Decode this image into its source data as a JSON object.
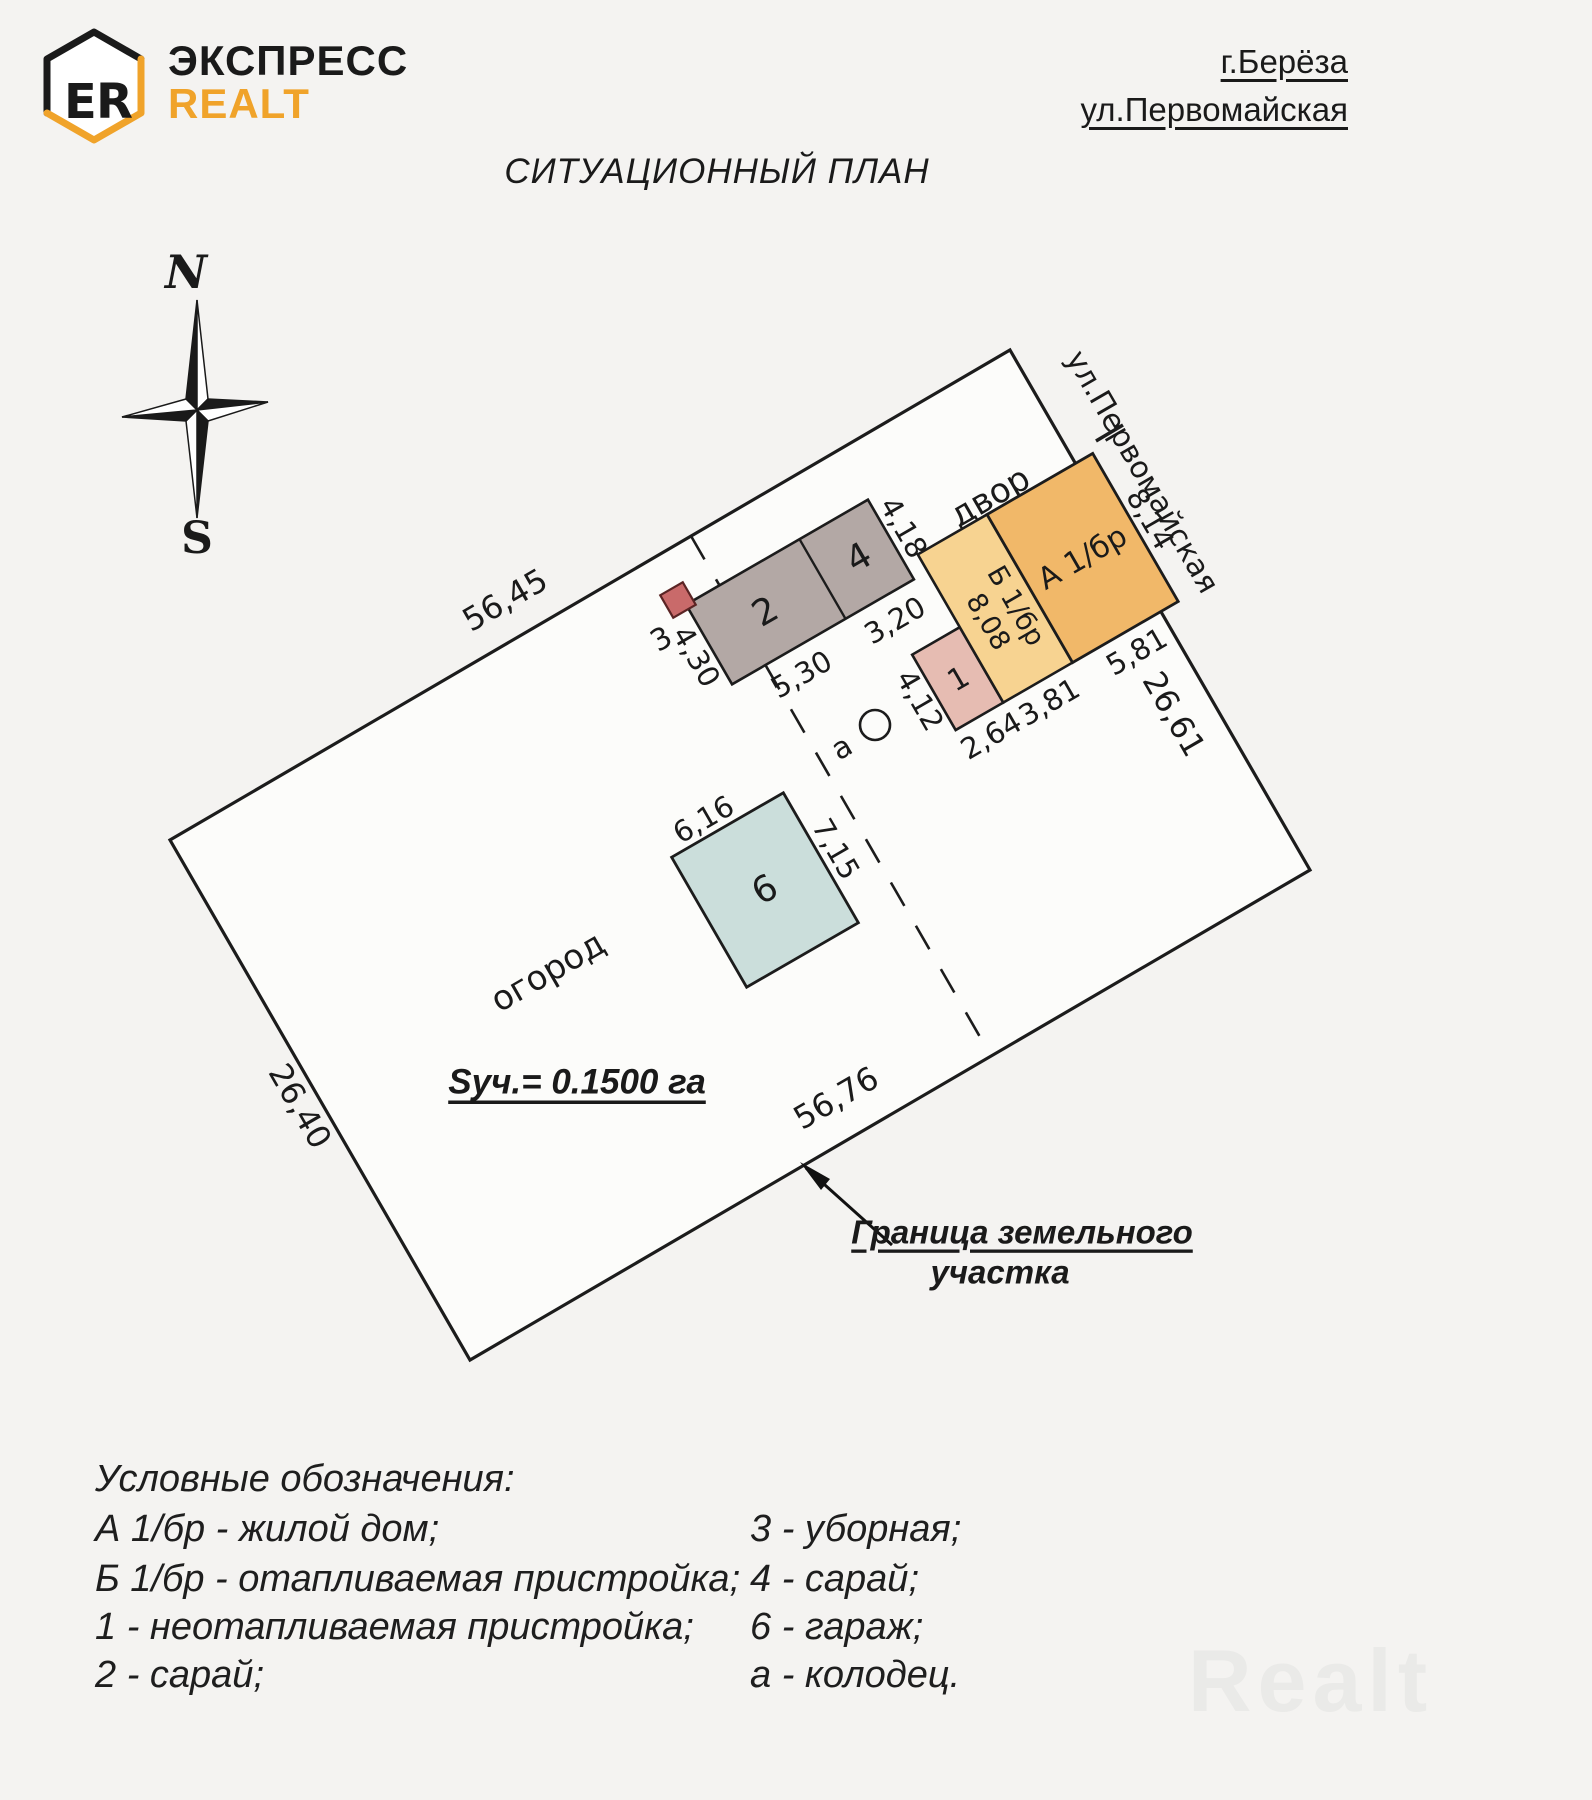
{
  "header": {
    "logo": {
      "letter_e": "E",
      "letter_r": "R"
    },
    "brand_line1": "ЭКСПРЕСС",
    "brand_line2": "REALT",
    "address": {
      "city": "г.Берёза",
      "street": "ул.Первомайская"
    }
  },
  "title": "СИТУАЦИОННЫЙ ПЛАН",
  "compass": {
    "north": "N",
    "south": "S"
  },
  "plan": {
    "dims": {
      "top": "56,45",
      "left": "26,40",
      "bottom": "56,76",
      "right": "26,61"
    },
    "zones": {
      "yard": "двор",
      "garden": "огород",
      "street": "ул.Первомайская"
    },
    "area_label": "Sуч.= 0.1500 га",
    "boundary_note": {
      "line1": "Граница земельного",
      "line2": "участка"
    },
    "buildings": {
      "house_label": "А 1/бр",
      "house_dim_right": "8,14",
      "house_dim_bottom": "5,81",
      "annex_label": "Б 1/бр",
      "annex_dim_width": "8,08",
      "annex_dim_bottom": "3,81",
      "porch_label": "1",
      "porch_dim_left": "4,12",
      "porch_dim_bottom": "2,64",
      "shed2_label": "2",
      "shed2_dim_bottom": "5,30",
      "shed2_dim_left": "4,30",
      "shed4_label": "4",
      "shed4_dim_bottom": "3,20",
      "shed4_dim_right": "4,18",
      "outhouse_label": "3",
      "garage_label": "6",
      "garage_dim_top": "6,16",
      "garage_dim_right": "7,15",
      "well_label": "а"
    }
  },
  "legend": {
    "title": "Условные обозначения:",
    "left": [
      "А 1/бр - жилой дом;",
      "Б 1/бр - отапливаемая пристройка;",
      "1 - неотапливаемая пристройка;",
      "2 - сарай;"
    ],
    "right": [
      "3 - уборная;",
      "4 - сарай;",
      "6 - гараж;",
      "а - колодец."
    ]
  },
  "watermark": "Realt",
  "colors": {
    "accent_orange": "#f0a32a",
    "house": "#f1b869",
    "annex": "#f7d391",
    "porch": "#e6bcb2",
    "shed": "#b3a8a5",
    "outhouse": "#c96a6a",
    "garage": "#cbdedb",
    "plot_fill": "#fcfcfa",
    "compass_north": "#3e5c7f",
    "compass_south": "#a0344a"
  }
}
